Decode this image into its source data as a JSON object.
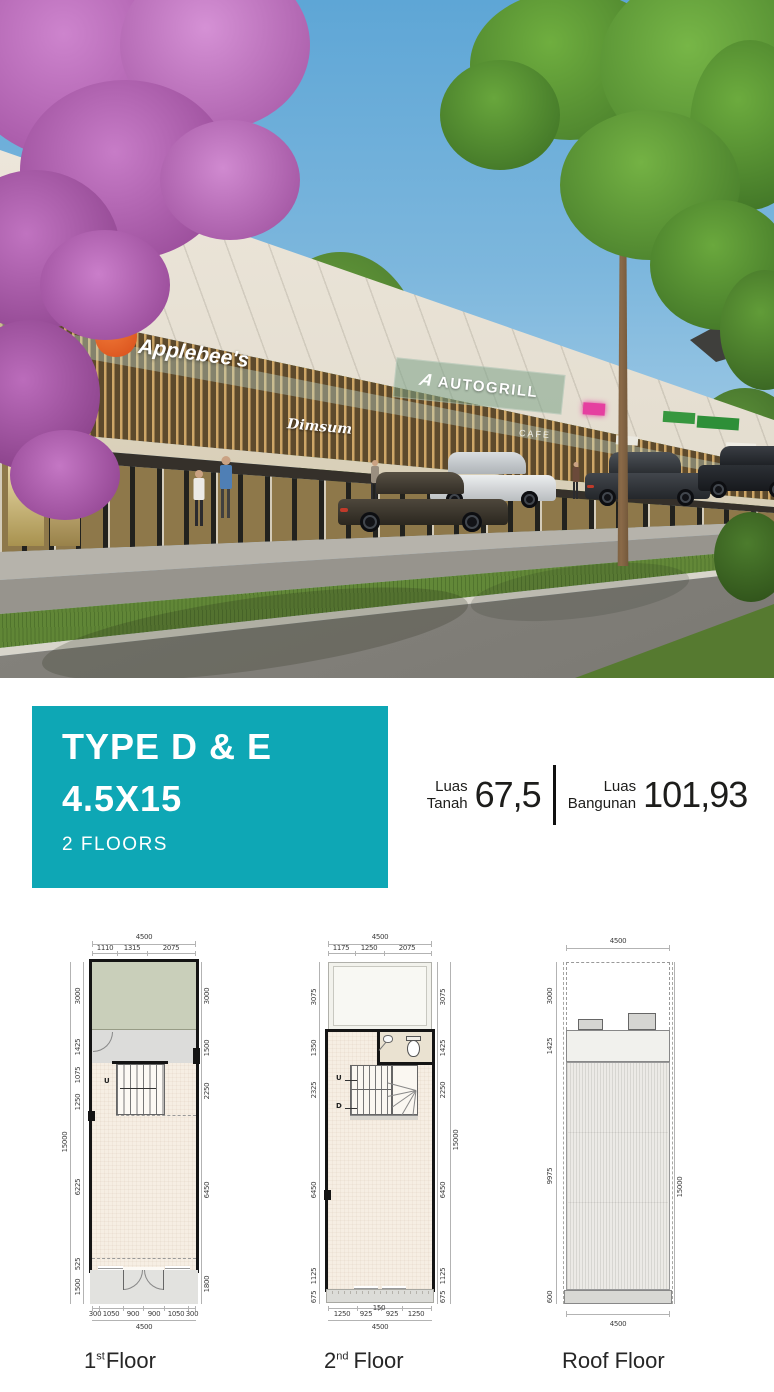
{
  "hero": {
    "signs": {
      "applebees": "Applebee's",
      "dimsum": "Dimsum",
      "autogrill": "AUTOGRILL",
      "autogrill_logo": "A",
      "cafe": "CAFE"
    }
  },
  "banner": {
    "title_line1": "TYPE D & E",
    "title_line2": "4.5X15",
    "subtitle": "2 FLOORS",
    "accent_color": "#0ea7b5"
  },
  "stats": [
    {
      "label_top": "Luas",
      "label_bottom": "Tanah",
      "value": "67,5"
    },
    {
      "label_top": "Luas",
      "label_bottom": "Bangunan",
      "value": "101,93"
    }
  ],
  "plans": [
    {
      "name_number": "1",
      "name_suffix": "st",
      "name_word": "Floor",
      "top_total": "4500",
      "top_segments": [
        "1110",
        "1315",
        "2075"
      ],
      "left_dims": [
        "3000",
        "1425",
        "1075",
        "1250",
        "6225",
        "525",
        "1500"
      ],
      "left_total": "15000",
      "right_dims": [
        "3000",
        "1500",
        "2250",
        "6450",
        "1800"
      ],
      "bottom_segments": [
        "300",
        "1050",
        "900",
        "900",
        "1050",
        "300"
      ],
      "bottom_total": "4500",
      "stair_up_label": "U"
    },
    {
      "name_number": "2",
      "name_suffix": "nd",
      "name_word": "Floor",
      "top_total": "4500",
      "top_segments": [
        "1175",
        "1250",
        "2075"
      ],
      "left_dims": [
        "3075",
        "1350",
        "2325",
        "6450",
        "1125",
        "675"
      ],
      "right_dims": [
        "3075",
        "1425",
        "2250",
        "6450",
        "1125",
        "675"
      ],
      "right_total": "15000",
      "bottom_segments": [
        "1250",
        "925",
        "150",
        "925",
        "1250"
      ],
      "bottom_total": "4500",
      "stair_up_label": "U",
      "stair_down_label": "D"
    },
    {
      "name_word": "Roof Floor",
      "top_total": "4500",
      "left_dims": [
        "3000",
        "1425",
        "9975",
        "600"
      ],
      "right_total": "15000",
      "bottom_total": "4500"
    }
  ]
}
